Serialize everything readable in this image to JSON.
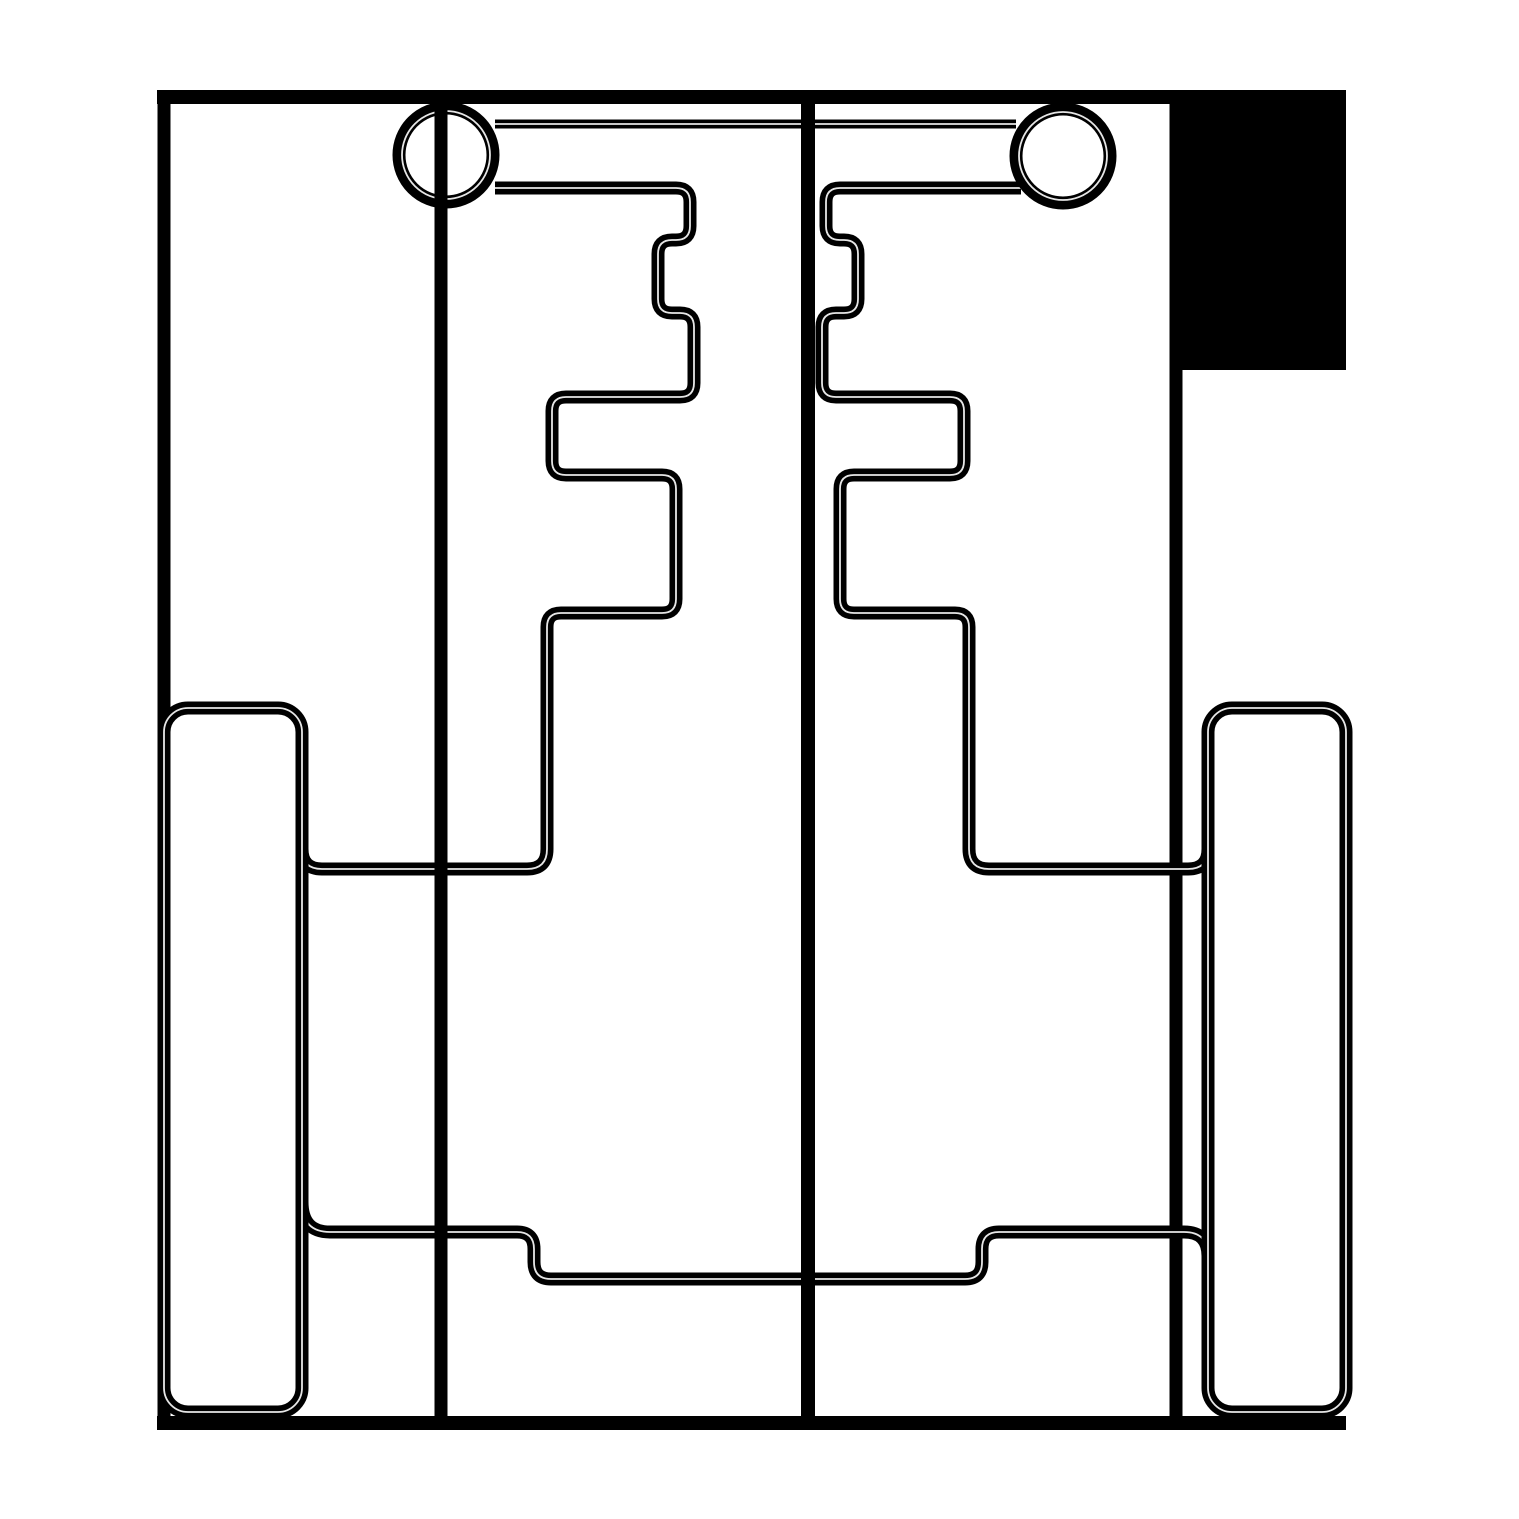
{
  "canvas": {
    "width": 1519,
    "height": 1519,
    "background_color": "#ffffff",
    "ink_color": "#000000",
    "hairline_color": "#ffffff",
    "main_stroke_width": 13,
    "edge_stroke_width": 14,
    "thin_stroke_width": 9,
    "hairline_width": 1.8
  },
  "figure": {
    "kind": "technical-line-schematic",
    "description": "Black-on-white plan-view mechanical line drawing: outer frame, filled corner block, two ringed pivot circles joined by a top crossbar, mirrored stepped gate paths, two wheel-like rounded rectangles, two vertical axis lines and a stepped lower cross-band"
  },
  "shapes": [
    {
      "name": "corner-flag-filled-block",
      "type": "rect",
      "x": 1171,
      "y": 90,
      "w": 175,
      "h": 280,
      "fill": true
    },
    {
      "name": "outer-top-edge",
      "type": "line",
      "x1": 157,
      "y1": 97,
      "x2": 1346,
      "y2": 97,
      "w": 14
    },
    {
      "name": "outer-left-edge",
      "type": "line",
      "x1": 164,
      "y1": 90,
      "x2": 164,
      "y2": 1430,
      "w": 13
    },
    {
      "name": "outer-bottom-edge",
      "type": "line",
      "x1": 157,
      "y1": 1423,
      "x2": 1346,
      "y2": 1423,
      "w": 14
    },
    {
      "name": "body-right-edge",
      "type": "line",
      "x1": 1176,
      "y1": 90,
      "x2": 1176,
      "y2": 1430,
      "w": 13
    },
    {
      "name": "top-crossbar-line",
      "type": "path",
      "w": 9,
      "hairline": true,
      "d": "M 495 124 L 1016 124"
    },
    {
      "name": "left-gate-path",
      "type": "path",
      "w": 13,
      "hairline": true,
      "d": "M 495 188 L 676 188 Q 690 188 690 202 L 690 226 Q 690 240 676 240 L 672 240 Q 658 240 658 254 L 658 299 Q 658 313 672 313 L 680 313 Q 694 313 694 327 L 694 383 Q 694 397 680 397 L 566 397 Q 552 397 552 411 L 552 461 Q 552 475 566 475 L 662 475 Q 676 475 676 489 L 676 599 Q 676 613 662 613 L 561 613 Q 547 613 547 627 L 547 849 Q 547 869 527 869 L 322 869 Q 302 869 302 849 L 302 788"
    },
    {
      "name": "right-gate-path",
      "type": "path",
      "w": 13,
      "hairline": true,
      "d": "M 1021 188 L 840 188 Q 826 188 826 202 L 826 226 Q 826 240 840 240 L 844 240 Q 858 240 858 254 L 858 299 Q 858 313 844 313 L 836 313 Q 822 313 822 327 L 822 383 Q 822 397 836 397 L 950 397 Q 964 397 964 411 L 964 461 Q 964 475 950 475 L 854 475 Q 840 475 840 489 L 840 599 Q 840 613 854 613 L 955 613 Q 969 613 969 627 L 969 849 Q 969 869 989 869 L 1188 869 Q 1208 869 1208 849 L 1208 788"
    },
    {
      "name": "lower-crossband-path",
      "type": "path",
      "w": 13,
      "hairline": true,
      "d": "M 302 1202 Q 302 1232 330 1232 L 517 1232 Q 534 1232 534 1249 L 534 1262 Q 534 1279 551 1279 L 965 1279 Q 982 1279 982 1262 L 982 1249 Q 982 1232 999 1232 L 1184 1232 Q 1208 1232 1208 1256 L 1208 1300"
    },
    {
      "name": "left-wheel-outline",
      "type": "rrect",
      "x": 164,
      "y": 708,
      "w": 138,
      "h": 704,
      "rx": 24,
      "sw": 13,
      "hairline": true
    },
    {
      "name": "right-wheel-outline",
      "type": "rrect",
      "x": 1208,
      "y": 708,
      "w": 138,
      "h": 704,
      "rx": 24,
      "sw": 13,
      "hairline": true
    },
    {
      "name": "left-pivot-circle",
      "type": "ring",
      "cx": 446,
      "cy": 155,
      "r": 47,
      "sw": 13,
      "hr": 44
    },
    {
      "name": "right-pivot-circle",
      "type": "ring",
      "cx": 1063,
      "cy": 156,
      "r": 47,
      "sw": 13,
      "hr": 44
    },
    {
      "name": "left-axis-line",
      "type": "line",
      "x1": 441,
      "y1": 92,
      "x2": 441,
      "y2": 1429,
      "w": 13
    },
    {
      "name": "center-axis-line",
      "type": "line",
      "x1": 808,
      "y1": 91,
      "x2": 808,
      "y2": 1429,
      "w": 14
    }
  ]
}
